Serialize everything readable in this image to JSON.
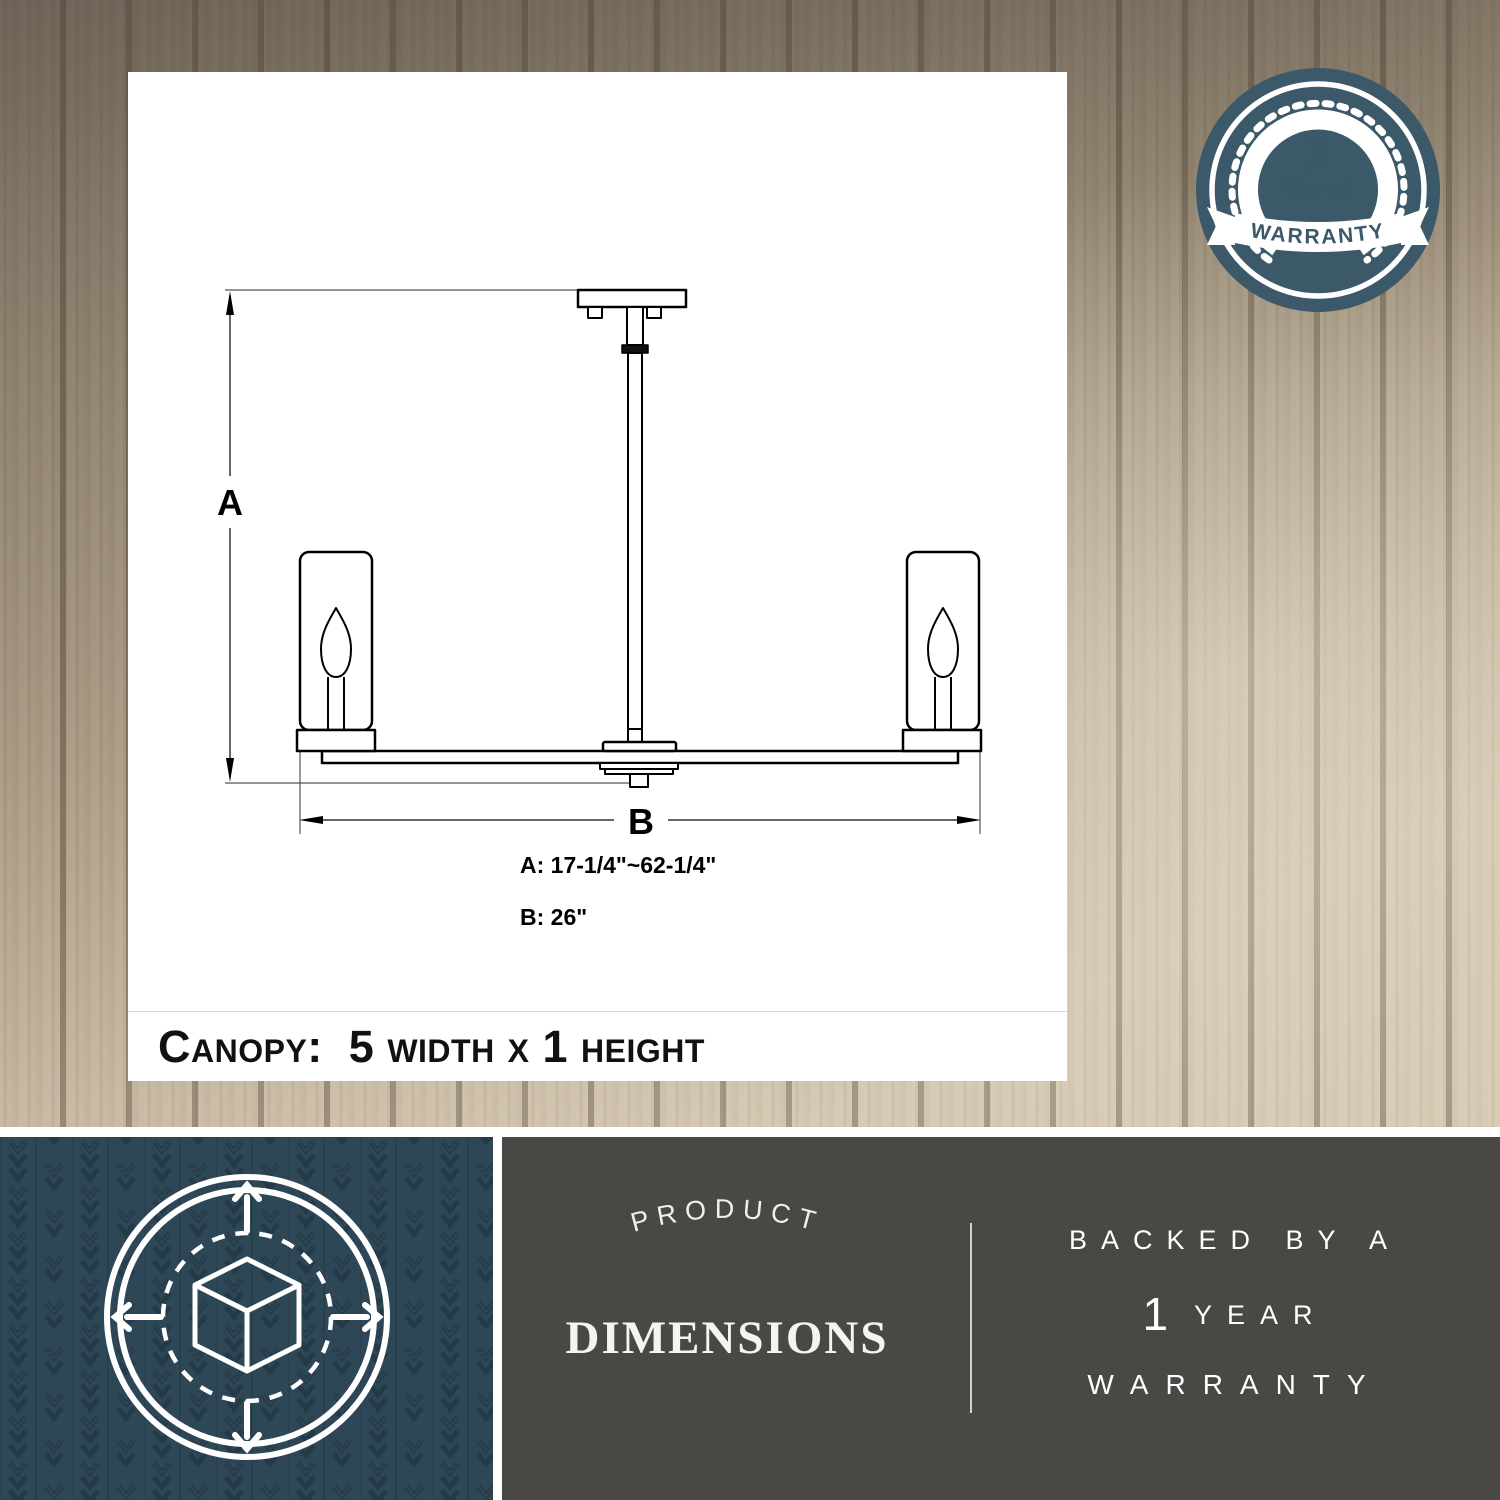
{
  "colors": {
    "badgeTeal": "#3b5968",
    "boxTeal": "#2d4757",
    "boxGray": "#4a4845",
    "ink": "#000000"
  },
  "panel": {
    "dim_label_a": "A",
    "dim_label_b": "B",
    "dim_value_a": "A: 17-1/4\"~62-1/4\"",
    "dim_value_b": "B: 26\"",
    "canopy_note": "Canopy:  5 width x 1 height"
  },
  "badge": {
    "number": "1",
    "year": "YEAR",
    "warranty": "WARRANTY"
  },
  "band": {
    "arched": "PRODUCT",
    "title": "DIMENSIONS",
    "right_line1": "BACKED BY A",
    "right_number": "1",
    "right_year": "YEAR",
    "right_line3": "WARRANTY"
  }
}
